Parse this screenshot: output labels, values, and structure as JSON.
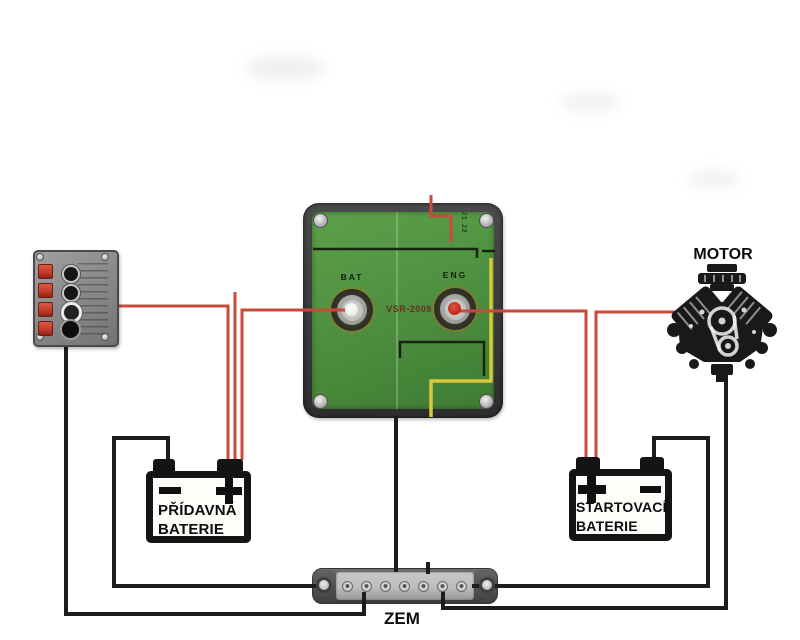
{
  "diagram_title": "VSR dual battery wiring diagram",
  "colors": {
    "wire_red": "#c84a3a",
    "wire_black": "#1c1c1c",
    "pcb_green_light": "#5da04a",
    "pcb_green_dark": "#3f7c33",
    "module_rim": "#3c3c3c",
    "trace_yellow": "#d9c83e",
    "trace_dark": "#16250f",
    "eng_center": "#c3251b",
    "battery_border": "#141414",
    "panel_light": "#a0a0a0",
    "panel_dark": "#737373",
    "rocker_red": "#c1392a",
    "busbar_dark": "#4e4e4e",
    "busbar_plate": "#bdbdbd"
  },
  "vsr_module": {
    "bat_terminal_label": "BAT",
    "eng_terminal_label": "ENG",
    "model": "VSR-2008",
    "jumper_label": "J1 J2"
  },
  "aux_battery": {
    "name_line1": "PŘÍDAVNÁ",
    "name_line2": "BATERIE",
    "left_polarity": "-",
    "right_polarity": "+"
  },
  "starter_battery": {
    "name_line1": "STARTOVACÍ",
    "name_line2": "BATERIE",
    "left_polarity": "+",
    "right_polarity": "-"
  },
  "motor": {
    "label": "MOTOR"
  },
  "ground_bus": {
    "label": "ZEM"
  }
}
